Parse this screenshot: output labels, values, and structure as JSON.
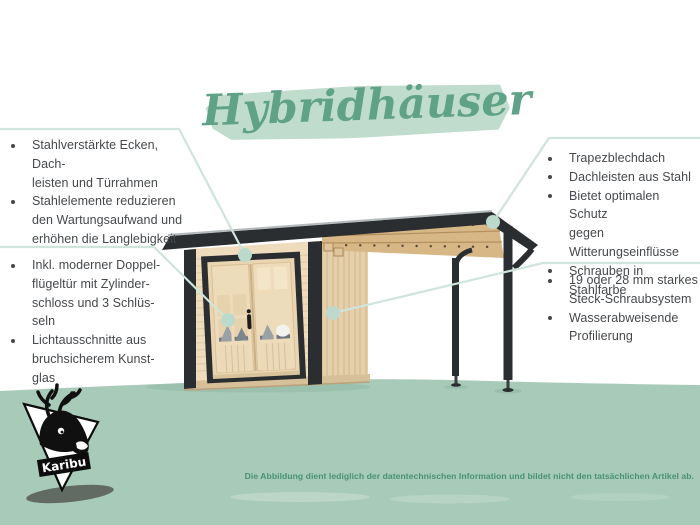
{
  "title": "Hybridhäuser",
  "callouts": {
    "top_left": {
      "items": [
        "Stahlverstärkte Ecken, Dach-\nleisten und Türrahmen",
        "Stahlelemente reduzieren\nden Wartungsaufwand und\nerhöhen die Langlebigkeit"
      ]
    },
    "bottom_left": {
      "items": [
        "Inkl. moderner Doppel-\nflügeltür mit Zylinder-\nschloss und 3 Schlüs-\nseln",
        "Lichtausschnitte aus\nbruchsicherem Kunst-\nglas"
      ]
    },
    "top_right": {
      "items": [
        "Trapezblechdach",
        "Dachleisten aus Stahl",
        "Bietet optimalen Schutz\ngegen Witterungseinflüsse",
        "Schrauben in Stahlfarbe"
      ]
    },
    "bottom_right": {
      "items": [
        "19 oder 28 mm starkes\nSteck-Schraubsystem",
        "Wasserabweisende\nProfilierung"
      ]
    }
  },
  "logo": {
    "brand": "Karibu"
  },
  "disclaimer": "Die Abbildung dient lediglich der datentechnischen Information und bildet nicht den tatsächlichen Artikel ab.",
  "colors": {
    "accent_green": "#5fa287",
    "brush_green": "#c0dccd",
    "ground_green": "#a8cab9",
    "callout_line": "#cfe4da",
    "callout_dot": "#bcdacb",
    "text_dark": "#45494c",
    "disclaimer_green": "#47936f",
    "roof_dark": "#2b2e30",
    "wood_light": "#eedcbd",
    "wood_side": "#e6d0ab",
    "wood_beam": "#d8b787"
  }
}
